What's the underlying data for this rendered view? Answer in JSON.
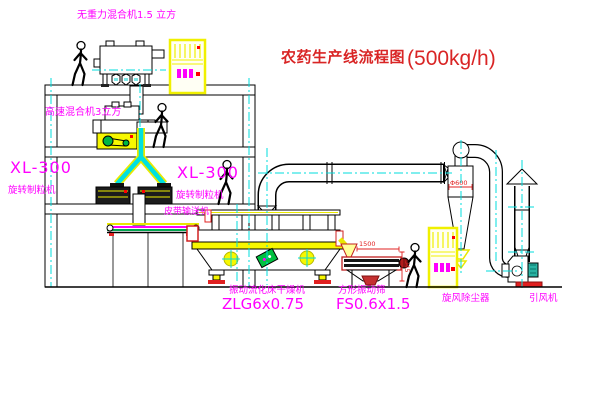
{
  "title": {
    "text": "农药生产线流程图",
    "capacity": "(500kg/h)"
  },
  "equipment": {
    "top_mixer": {
      "label": "无重力混合机1.5 立方"
    },
    "mid_mixer": {
      "label": "高速混合机3立方"
    },
    "granulator_left": {
      "model": "XL-300",
      "name": "旋转制粒机"
    },
    "granulator_right": {
      "model": "XL-300",
      "name": "旋转制粒机"
    },
    "belt_conveyor": {
      "label": "皮带输送机"
    },
    "dryer": {
      "name": "振动流化床干燥机",
      "model": "ZLG6x0.75"
    },
    "sieve": {
      "name": "方形振动筛",
      "model": "FS0.6x1.5"
    },
    "cyclone": {
      "name": "旋风除尘器",
      "dim": "Φ600"
    },
    "fan": {
      "name": "引风机"
    }
  },
  "dimensions": {
    "sieve_length": "1500",
    "sieve_height": "345"
  },
  "colors": {
    "background": "#ffffff",
    "line_black": "#000000",
    "centerline_cyan": "#00dcdc",
    "equipment_yellow": "#f0f000",
    "label_magenta": "#ff00ff",
    "title_red": "#d92525",
    "dimension_red": "#e02020",
    "accent_green": "#00b544",
    "motor_teal": "#2ab3a3"
  }
}
